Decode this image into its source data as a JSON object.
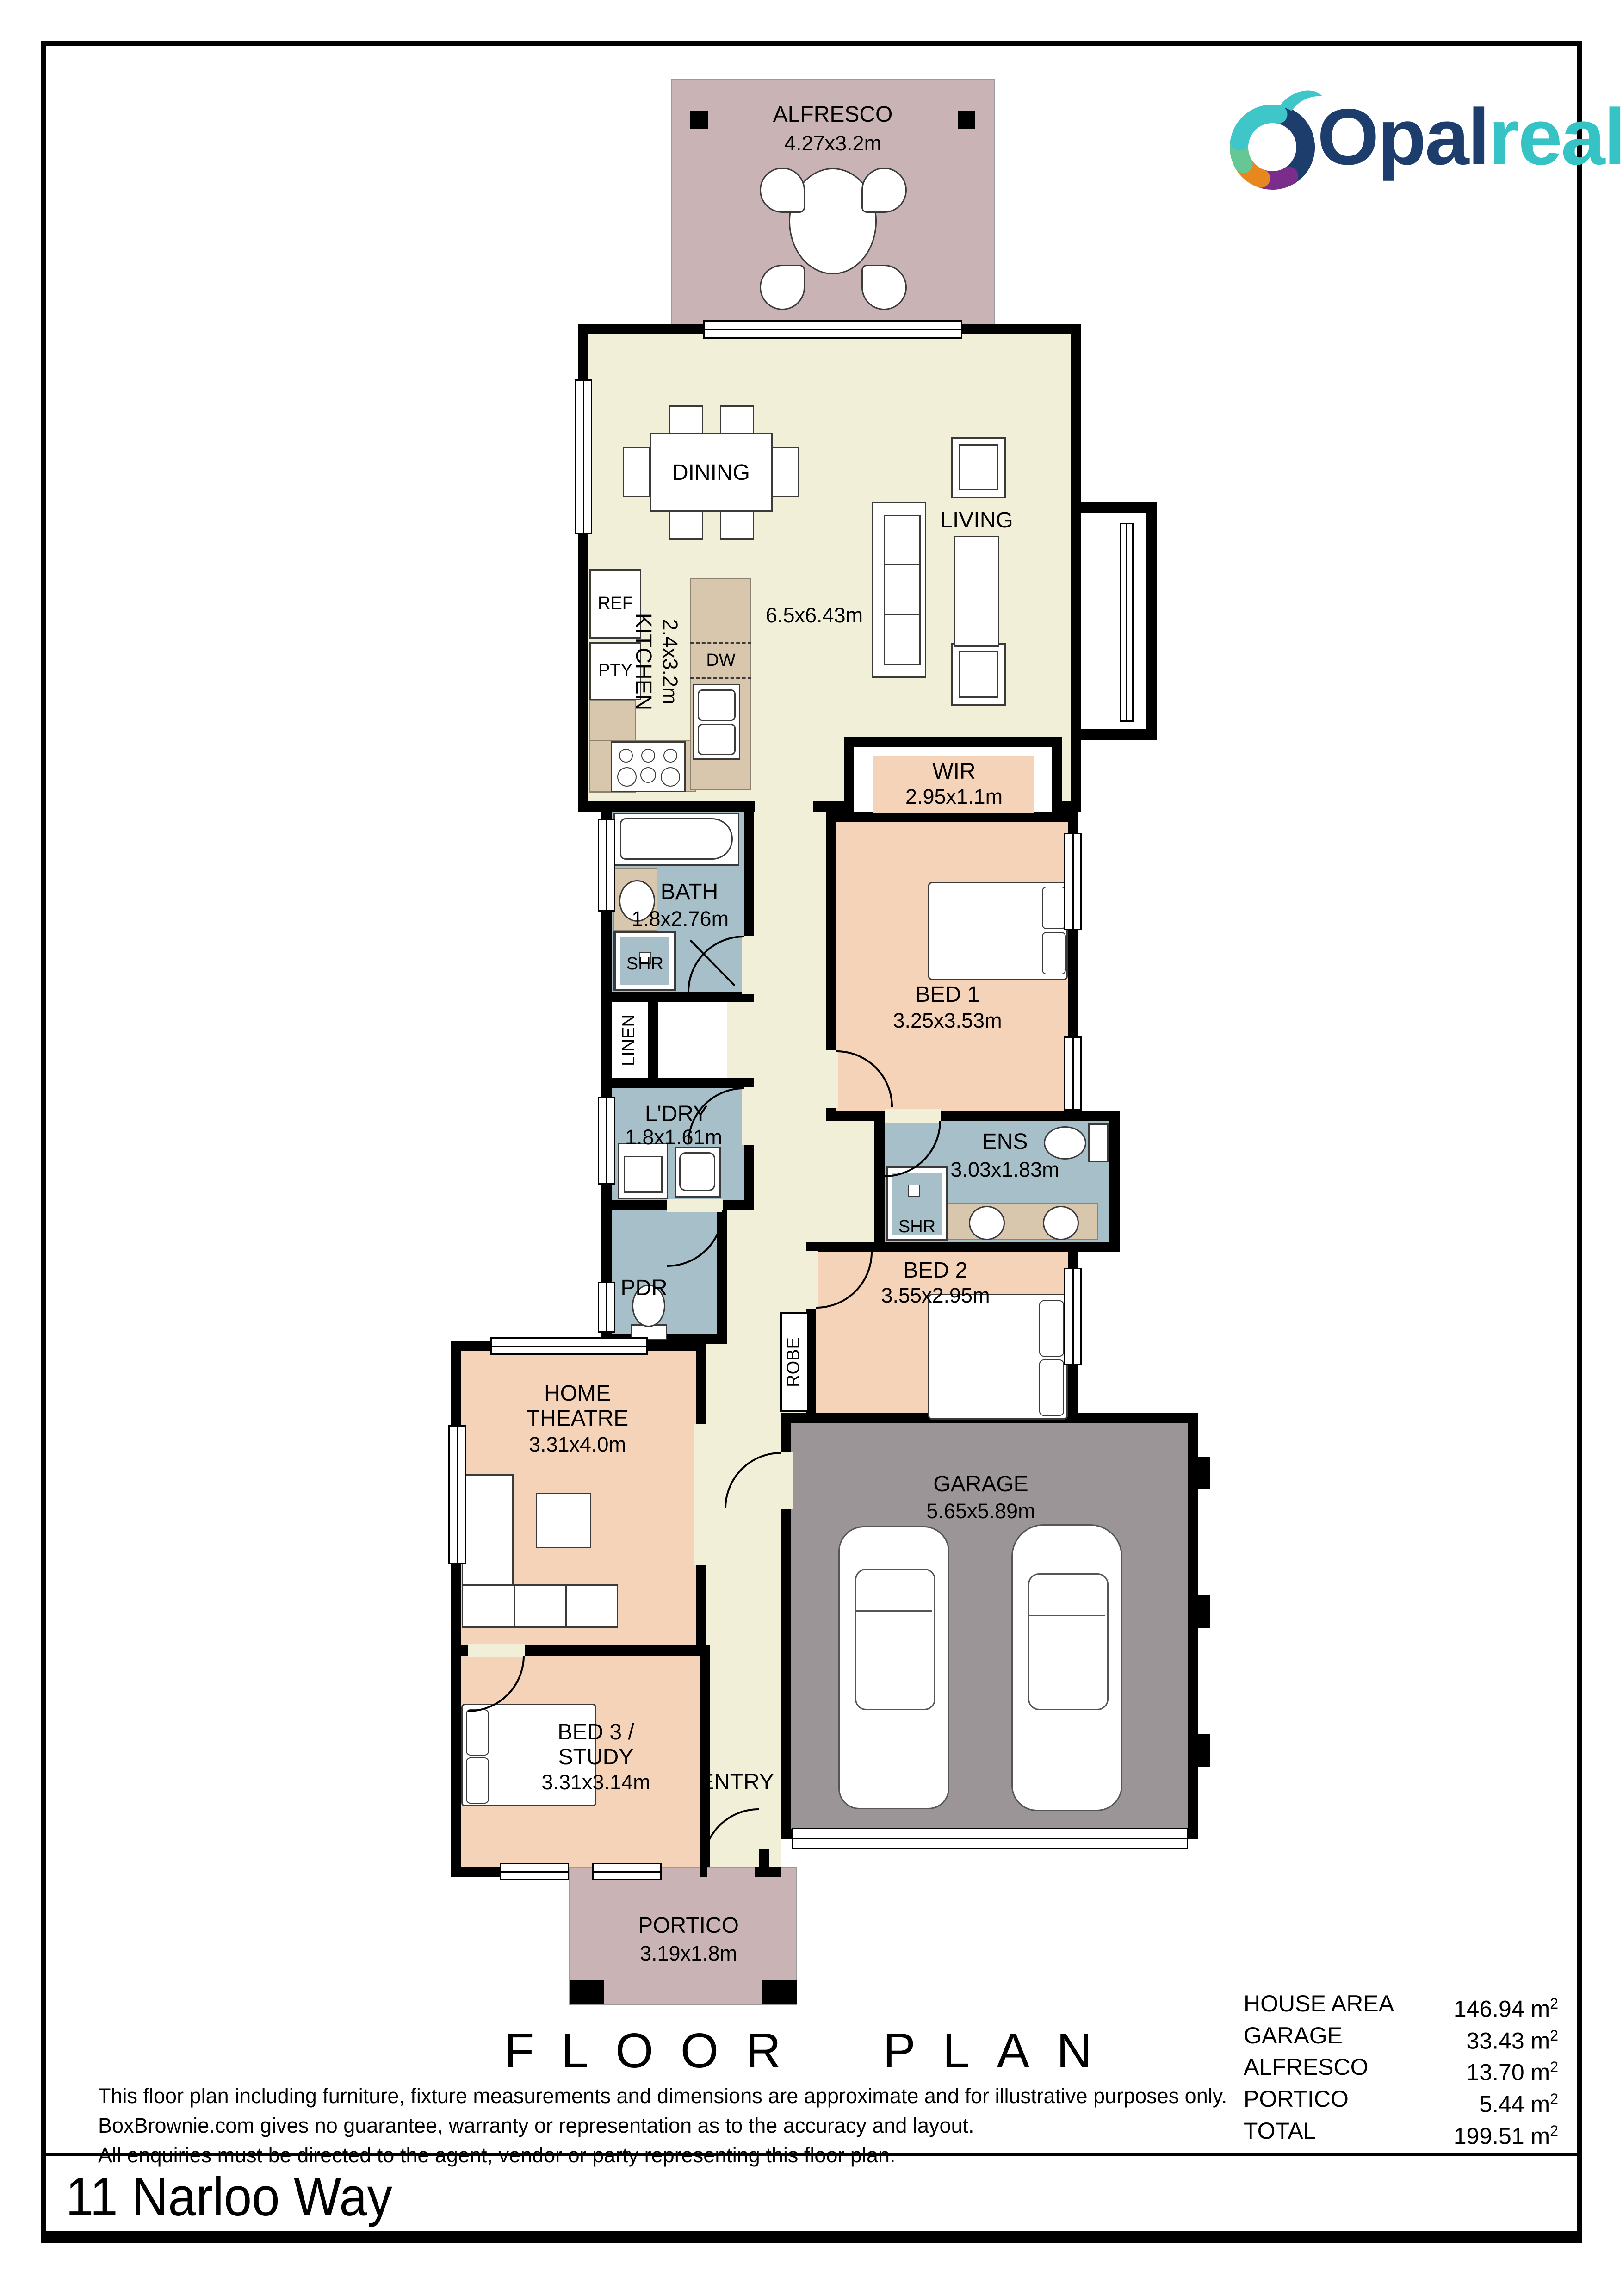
{
  "logo": {
    "brand_primary": "Opal",
    "brand_secondary": "realty",
    "primary_color": "#1d3d6d",
    "secondary_color": "#35c3c6"
  },
  "palette": {
    "floor_cream": "#f1efd8",
    "bedroom_peach": "#f5d3b8",
    "wet_area_blue": "#a7bfc8",
    "outdoor_mauve": "#c9b3b5",
    "garage_gray": "#9b9597",
    "bench_marble": "#d9c7ad",
    "wall_black": "#000000"
  },
  "rooms": {
    "alfresco": {
      "label": "ALFRESCO",
      "dims": "4.27x3.2m"
    },
    "dining": {
      "label": "DINING"
    },
    "living": {
      "label": "LIVING",
      "dims": "6.5x6.43m"
    },
    "kitchen": {
      "label": "KITCHEN",
      "dims": "2.4x3.2m"
    },
    "ref": {
      "label": "REF"
    },
    "pty": {
      "label": "PTY"
    },
    "dw": {
      "label": "DW"
    },
    "bath": {
      "label": "BATH",
      "dims": "1.8x2.76m"
    },
    "shr_bath": {
      "label": "SHR"
    },
    "linen": {
      "label": "LINEN"
    },
    "wir": {
      "label": "WIR",
      "dims": "2.95x1.1m"
    },
    "bed1": {
      "label": "BED 1",
      "dims": "3.25x3.53m"
    },
    "ldry": {
      "label": "L'DRY",
      "dims": "1.8x1.61m"
    },
    "ens": {
      "label": "ENS",
      "dims": "3.03x1.83m"
    },
    "shr_ens": {
      "label": "SHR"
    },
    "bed2": {
      "label": "BED 2",
      "dims": "3.55x2.95m"
    },
    "pdr": {
      "label": "PDR"
    },
    "robe": {
      "label": "ROBE"
    },
    "home_theatre": {
      "line1": "HOME",
      "line2": "THEATRE",
      "dims": "3.31x4.0m"
    },
    "garage": {
      "label": "GARAGE",
      "dims": "5.65x5.89m"
    },
    "bed3": {
      "line1": "BED 3 /",
      "line2": "STUDY",
      "dims": "3.31x3.14m"
    },
    "entry": {
      "label": "ENTRY"
    },
    "portico": {
      "label": "PORTICO",
      "dims": "3.19x1.8m"
    }
  },
  "footer": {
    "title": "FLOOR PLAN",
    "disclaimer": [
      "This floor plan including furniture, fixture measurements and dimensions are approximate and for illustrative purposes only.",
      "BoxBrownie.com gives no guarantee, warranty or representation as to the accuracy and layout.",
      "All enquiries must be directed to the agent, vendor or party representing this floor plan."
    ],
    "areas": [
      {
        "label": "HOUSE AREA",
        "value": "146.94"
      },
      {
        "label": "GARAGE",
        "value": "33.43"
      },
      {
        "label": "ALFRESCO",
        "value": "13.70"
      },
      {
        "label": "PORTICO",
        "value": "5.44"
      },
      {
        "label": "TOTAL",
        "value": "199.51"
      }
    ],
    "area_unit": "m",
    "area_unit_sup": "2"
  },
  "address": "11 Narloo Way"
}
